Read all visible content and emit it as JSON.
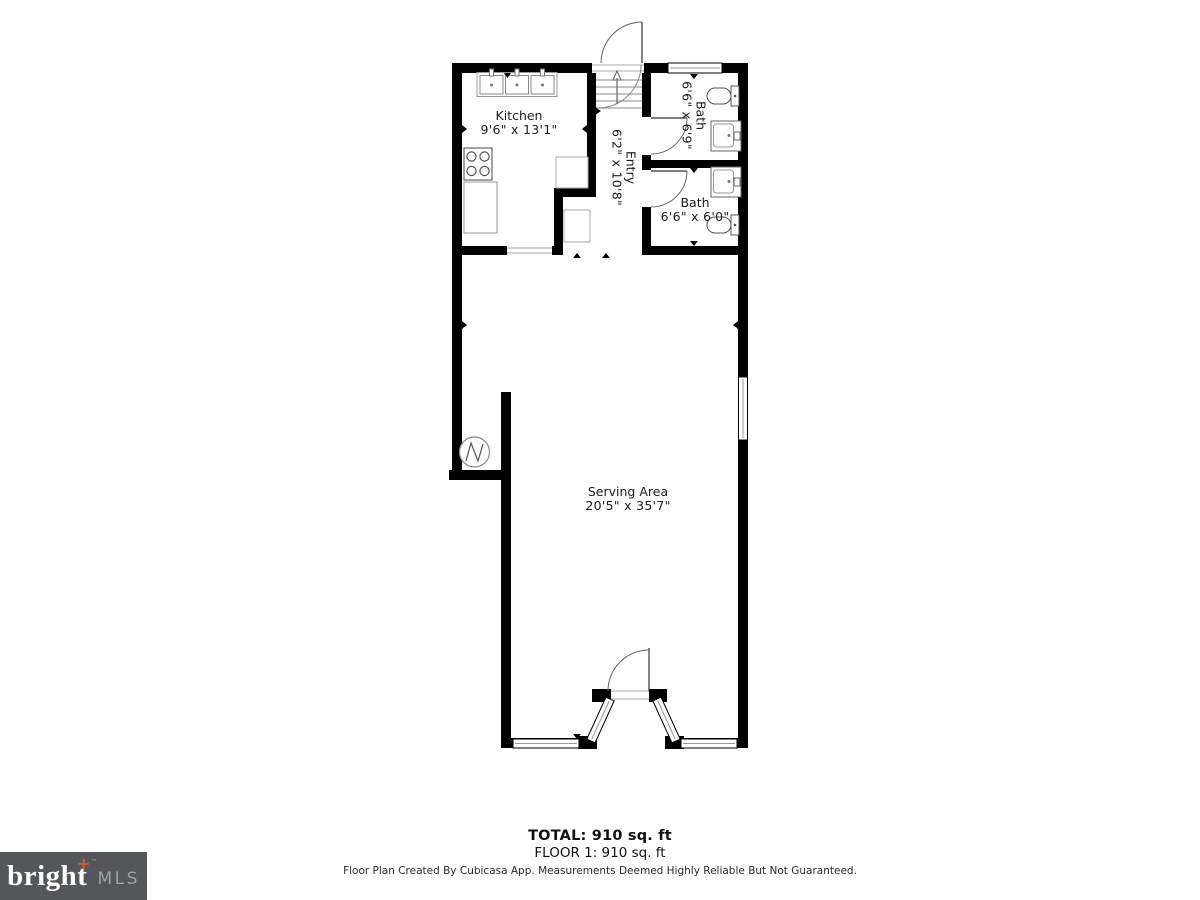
{
  "page": {
    "background": "#ffffff"
  },
  "plan": {
    "wall_color": "#000000",
    "rooms": [
      {
        "name": "Kitchen",
        "dims": "9'6\" x 13'1\""
      },
      {
        "name": "Entry",
        "dims": "6'2\" x 10'8\""
      },
      {
        "name": "Bath",
        "dims": "6'6\" x 6'9\""
      },
      {
        "name": "Bath",
        "dims": "6'6\" x 6'0\""
      },
      {
        "name": "Serving Area",
        "dims": "20'5\" x 35'7\""
      }
    ]
  },
  "summary": {
    "total": "TOTAL: 910 sq. ft",
    "floor": "FLOOR 1: 910 sq. ft"
  },
  "disclaimer": "Floor Plan Created By Cubicasa App. Measurements Deemed Highly Reliable But Not Guaranteed.",
  "logo": {
    "brand": "bright",
    "tm": "™",
    "suffix": "MLS",
    "bg": "#54565a",
    "brand_color": "#ffffff",
    "accent": "#e0552b",
    "suffix_color": "#9aa0a4"
  }
}
